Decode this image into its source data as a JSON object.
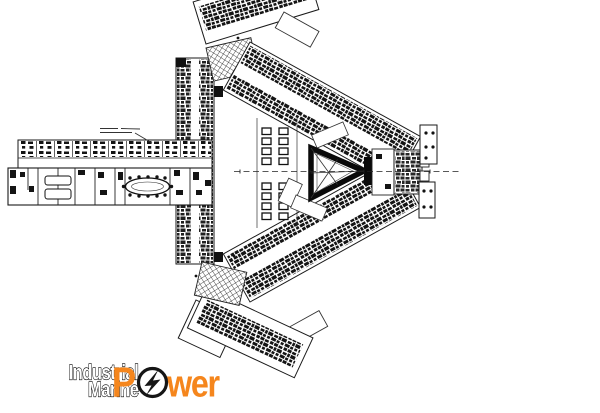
{
  "canvas": {
    "width": 600,
    "height": 413,
    "background": "#ffffff"
  },
  "floor_plan": {
    "kind": "scanned architectural floor plan, black and white",
    "description": "Tri-wing building floor plan: a west corridor wing with an oval conference table, two long diagonal room wings converging to an east vertex, a central triangular atrium with cross bracing, two cross-hatched roof squares, furniture grids, and a dashed east-west centerline",
    "ink_color": "#111111",
    "annotation": {
      "present": true,
      "legible": false
    }
  },
  "logo": {
    "line1": "Industrial",
    "line2": "Marine",
    "line3_p": "P",
    "line3_rest": "wer",
    "fill_color": "#ffffff",
    "outline_color": "#000000",
    "power_color": "#F5861D",
    "ring_color": "#161616",
    "icon": "lightning-bolt-icon"
  }
}
